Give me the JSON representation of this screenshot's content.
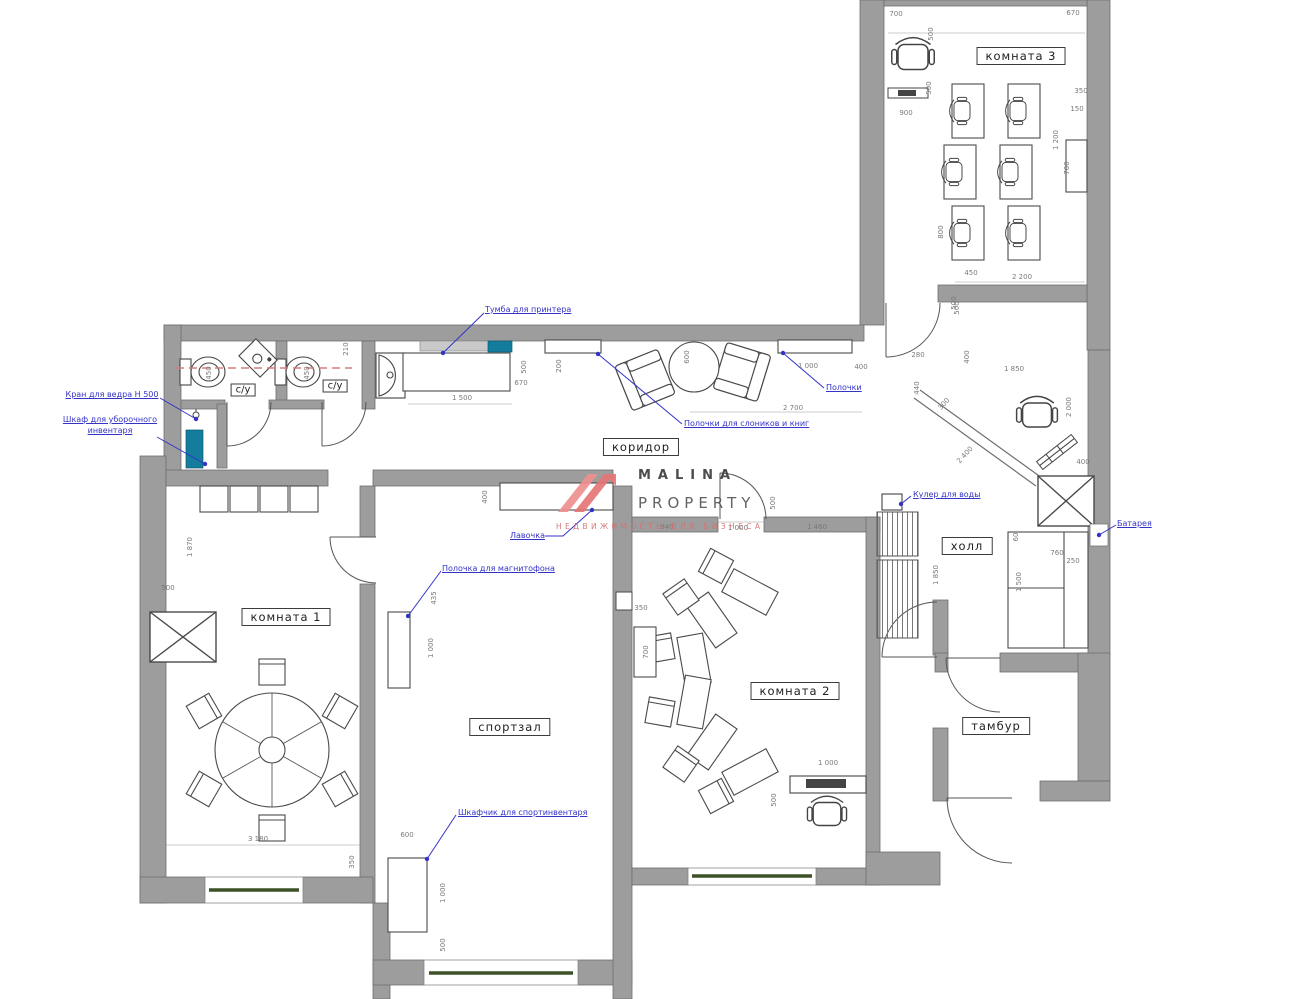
{
  "watermark": {
    "line1": "MALINA",
    "line2": "PROPERTY",
    "subtitle": "НЕДВИЖИМОСТЬ ДЛЯ БИЗНЕСА"
  },
  "colors": {
    "wall": "#9d9d9d",
    "wall_stroke": "#6f6f6f",
    "teal_cabinet": "#147c9c",
    "annotation_blue": "#3333c8",
    "dashed_red": "#d97b7b",
    "window_green": "#3c5226",
    "dim_text": "#7a7a7a"
  },
  "rooms": [
    {
      "label": "комната 3",
      "x": 1021,
      "y": 56
    },
    {
      "label": "с/у",
      "x": 243,
      "y": 390,
      "cls": "s"
    },
    {
      "label": "с/у",
      "x": 335,
      "y": 386,
      "cls": "s"
    },
    {
      "label": "коридор",
      "x": 641,
      "y": 447
    },
    {
      "label": "комната 1",
      "x": 286,
      "y": 617
    },
    {
      "label": "спортзал",
      "x": 510,
      "y": 727
    },
    {
      "label": "комната 2",
      "x": 795,
      "y": 691
    },
    {
      "label": "холл",
      "x": 967,
      "y": 546
    },
    {
      "label": "тамбур",
      "x": 996,
      "y": 726
    }
  ],
  "annotations": [
    {
      "t": "Тумба для принтера",
      "x": 485,
      "y": 305,
      "line": [
        [
          484,
          313
        ],
        [
          443,
          353
        ]
      ]
    },
    {
      "t": "Кран для ведра Н 500",
      "x": 60,
      "y": 390,
      "w": 104,
      "ta": "center",
      "line": [
        [
          160,
          398
        ],
        [
          196,
          419
        ]
      ]
    },
    {
      "t": "Шкаф для уборочного\nинвентаря",
      "x": 58,
      "y": 415,
      "w": 104,
      "ta": "center",
      "line": [
        [
          157,
          437
        ],
        [
          205,
          464
        ]
      ]
    },
    {
      "t": "Полочки",
      "x": 826,
      "y": 383,
      "line": [
        [
          824,
          388
        ],
        [
          783,
          353
        ]
      ]
    },
    {
      "t": "Полочки для слоников и книг",
      "x": 684,
      "y": 419,
      "line": [
        [
          682,
          424
        ],
        [
          598,
          354
        ]
      ]
    },
    {
      "t": "Лавочка",
      "x": 510,
      "y": 531,
      "line": [
        [
          545,
          536
        ],
        [
          563,
          536
        ],
        [
          592,
          510
        ]
      ]
    },
    {
      "t": "Полочка для магнитофона",
      "x": 442,
      "y": 564,
      "line": [
        [
          441,
          571
        ],
        [
          408,
          616
        ]
      ]
    },
    {
      "t": "Кулер для воды",
      "x": 913,
      "y": 490,
      "line": [
        [
          911,
          496
        ],
        [
          901,
          504
        ]
      ]
    },
    {
      "t": "Батарея",
      "x": 1117,
      "y": 519,
      "line": [
        [
          1116,
          525
        ],
        [
          1099,
          535
        ]
      ]
    },
    {
      "t": "Шкафчик для спортинвентаря",
      "x": 458,
      "y": 808,
      "line": [
        [
          456,
          815
        ],
        [
          427,
          859
        ]
      ]
    }
  ],
  "dimensions": [
    {
      "t": "700",
      "x": 896,
      "y": 14
    },
    {
      "t": "670",
      "x": 1073,
      "y": 13
    },
    {
      "t": "500",
      "x": 931,
      "y": 34,
      "r": -90
    },
    {
      "t": "500",
      "x": 929,
      "y": 88,
      "r": -90
    },
    {
      "t": "900",
      "x": 906,
      "y": 113
    },
    {
      "t": "350",
      "x": 1081,
      "y": 91
    },
    {
      "t": "150",
      "x": 1077,
      "y": 109
    },
    {
      "t": "1 200",
      "x": 1056,
      "y": 140,
      "r": -90
    },
    {
      "t": "700",
      "x": 1067,
      "y": 168,
      "r": -90
    },
    {
      "t": "800",
      "x": 941,
      "y": 232,
      "r": -90
    },
    {
      "t": "450",
      "x": 971,
      "y": 273
    },
    {
      "t": "2 200",
      "x": 1022,
      "y": 277
    },
    {
      "t": "500",
      "x": 957,
      "y": 308,
      "r": -90
    },
    {
      "t": "210",
      "x": 346,
      "y": 349,
      "r": -90
    },
    {
      "t": "450",
      "x": 209,
      "y": 373,
      "r": -90
    },
    {
      "t": "450",
      "x": 307,
      "y": 373,
      "r": -90
    },
    {
      "t": "500",
      "x": 524,
      "y": 367,
      "r": -90
    },
    {
      "t": "200",
      "x": 559,
      "y": 366,
      "r": -90
    },
    {
      "t": "670",
      "x": 521,
      "y": 383
    },
    {
      "t": "1 500",
      "x": 462,
      "y": 398
    },
    {
      "t": "400",
      "x": 485,
      "y": 497,
      "r": -90
    },
    {
      "t": "940",
      "x": 667,
      "y": 527
    },
    {
      "t": "1 000",
      "x": 738,
      "y": 528
    },
    {
      "t": "1 460",
      "x": 817,
      "y": 527
    },
    {
      "t": "500",
      "x": 773,
      "y": 503,
      "r": -90
    },
    {
      "t": "1 000",
      "x": 808,
      "y": 366
    },
    {
      "t": "400",
      "x": 861,
      "y": 367
    },
    {
      "t": "2 700",
      "x": 793,
      "y": 408
    },
    {
      "t": "600",
      "x": 687,
      "y": 357,
      "r": -90
    },
    {
      "t": "280",
      "x": 918,
      "y": 355
    },
    {
      "t": "400",
      "x": 967,
      "y": 357,
      "r": -90
    },
    {
      "t": "500",
      "x": 954,
      "y": 303,
      "r": -90
    },
    {
      "t": "440",
      "x": 917,
      "y": 388,
      "r": -90
    },
    {
      "t": "300",
      "x": 944,
      "y": 404,
      "r": -48
    },
    {
      "t": "1 850",
      "x": 1014,
      "y": 369
    },
    {
      "t": "2 000",
      "x": 1069,
      "y": 407,
      "r": -90
    },
    {
      "t": "2 400",
      "x": 965,
      "y": 455,
      "r": -48
    },
    {
      "t": "400",
      "x": 1083,
      "y": 462
    },
    {
      "t": "60",
      "x": 1016,
      "y": 537,
      "r": -90
    },
    {
      "t": "760",
      "x": 1057,
      "y": 553
    },
    {
      "t": "250",
      "x": 1073,
      "y": 561
    },
    {
      "t": "1 500",
      "x": 1019,
      "y": 582,
      "r": -90
    },
    {
      "t": "1 850",
      "x": 936,
      "y": 575,
      "r": -90
    },
    {
      "t": "1 870",
      "x": 190,
      "y": 547,
      "r": -90
    },
    {
      "t": "500",
      "x": 168,
      "y": 588
    },
    {
      "t": "3 180",
      "x": 258,
      "y": 839
    },
    {
      "t": "350",
      "x": 352,
      "y": 862,
      "r": -90
    },
    {
      "t": "435",
      "x": 434,
      "y": 598,
      "r": -90
    },
    {
      "t": "1 000",
      "x": 431,
      "y": 648,
      "r": -90
    },
    {
      "t": "600",
      "x": 407,
      "y": 835
    },
    {
      "t": "1 000",
      "x": 443,
      "y": 893,
      "r": -90
    },
    {
      "t": "500",
      "x": 443,
      "y": 945,
      "r": -90
    },
    {
      "t": "350",
      "x": 641,
      "y": 608
    },
    {
      "t": "700",
      "x": 646,
      "y": 652,
      "r": -90
    },
    {
      "t": "1 000",
      "x": 828,
      "y": 763
    },
    {
      "t": "500",
      "x": 774,
      "y": 800,
      "r": -90
    }
  ]
}
